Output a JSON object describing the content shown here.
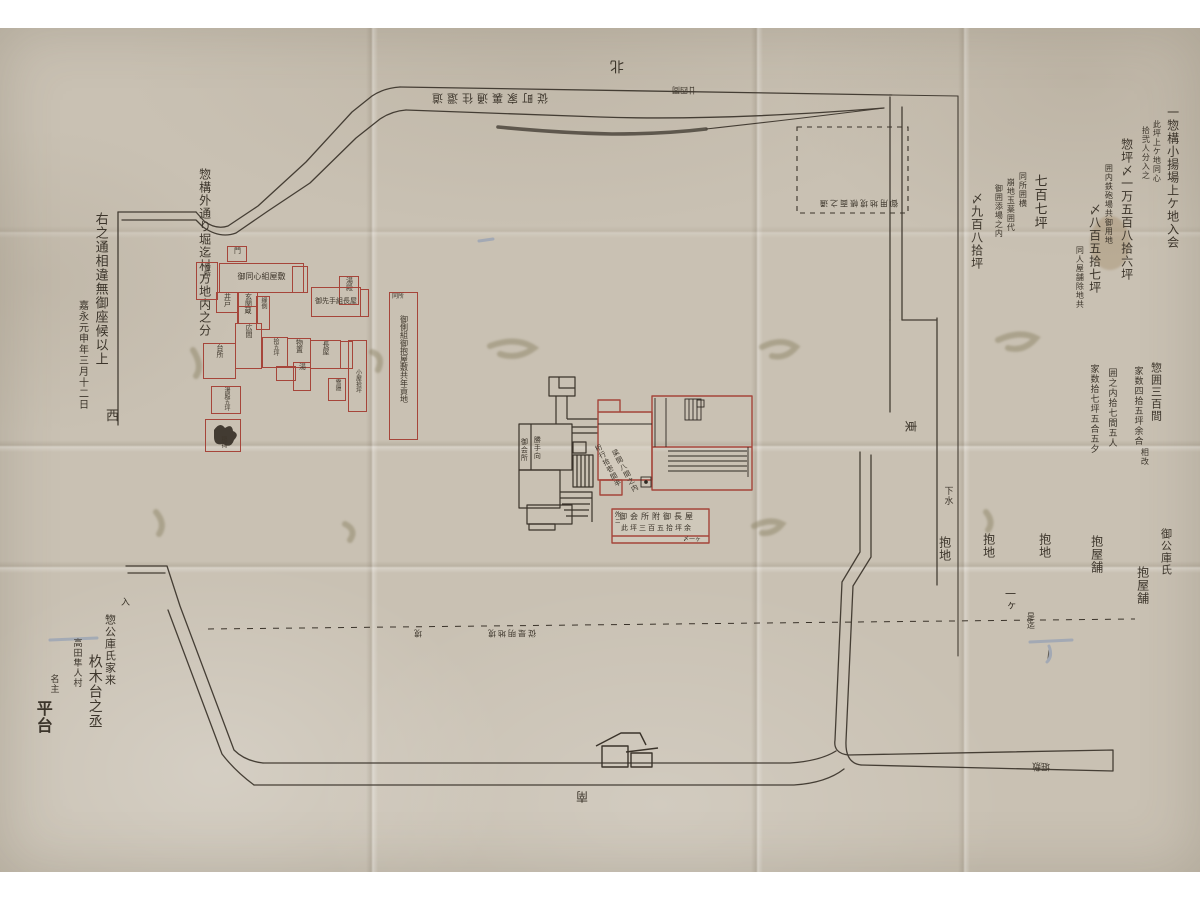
{
  "markers": {
    "north": "北",
    "south": "南",
    "east": "東",
    "west": "西"
  },
  "notes": {
    "band": "従町家裏通往還道",
    "band_width": "廿四間",
    "dashed_rect": "御用地境帳面之通",
    "dashed_mid": "従是明地境",
    "dashed_small": "境",
    "dashed_right": "是迄",
    "drain": "下水",
    "moat": "堀敷"
  },
  "left_block": {
    "main": "惣構外通り堀迄村方地内之分",
    "closing": "右之通相違無御座候以上",
    "date": "嘉永元申年三月十二日"
  },
  "top_right": {
    "cols": [
      "一惣構小揚場上ケ地入会",
      "此坪上ケ地同心",
      "拾弐人分入之",
      "惣坪〆一万五百八拾六坪",
      "囲内鉄砲場共御用地",
      "〆八百五拾七坪",
      "同人屋舗除地共",
      "同所囲横",
      "崩地玉薬囲代",
      "御囲添場之内",
      "七百七坪",
      "〆九百八拾坪"
    ]
  },
  "mid_right": {
    "cols": [
      "惣囲三百間",
      "家数四拾五坪余合",
      "囲之内拾七間五人",
      "家数拾七坪五合五夕"
    ],
    "sub": "相改"
  },
  "land": {
    "labels": [
      "御公庫氏",
      "抱屋舗",
      "抱屋舗",
      "抱地",
      "抱地",
      "一ヶ",
      "抱地"
    ]
  },
  "bottom_left": {
    "cols": [
      "入",
      "惣公庫氏家来",
      "高田隼人村",
      "杦木台之丞",
      "名主",
      "平台"
    ]
  },
  "complex": {
    "office_left": "御会所",
    "office_right": "勝手向",
    "room_diag_1": "桁行拾壱間半",
    "room_diag_2": "梁間八間之内",
    "plate_row1": "御会所附御長屋",
    "plate_row2": "此坪三百五拾坪余",
    "plate_note": "〆一ヶ",
    "plate_side": "外ニ"
  },
  "tall_plot": {
    "top": "同所"
  },
  "buildings": [
    {
      "label": "門"
    },
    {
      "label": "番所"
    },
    {
      "label": "御同心組屋敷"
    },
    {
      "label": ""
    },
    {
      "label": "井戸"
    },
    {
      "label": "玄関"
    },
    {
      "label": "縁側"
    },
    {
      "label": "湯殿"
    },
    {
      "label": "御先手組長屋"
    },
    {
      "label": ""
    },
    {
      "label": "蔵"
    },
    {
      "label": "広間"
    },
    {
      "label": "台所"
    },
    {
      "label": "拾五坪"
    },
    {
      "label": "物置"
    },
    {
      "label": "長屋"
    },
    {
      "label": ""
    },
    {
      "label": "小屋拾坪"
    },
    {
      "label": ""
    },
    {
      "label": "湯"
    },
    {
      "label": "雪隠"
    },
    {
      "label": "湯殿五坪"
    },
    {
      "label": "稲荷"
    },
    {
      "label": "御側組御抱屋敷共年貢地"
    }
  ],
  "colors": {
    "ink": "#3a332a",
    "red": "#a6453a",
    "paper": "#c9c1b3"
  }
}
